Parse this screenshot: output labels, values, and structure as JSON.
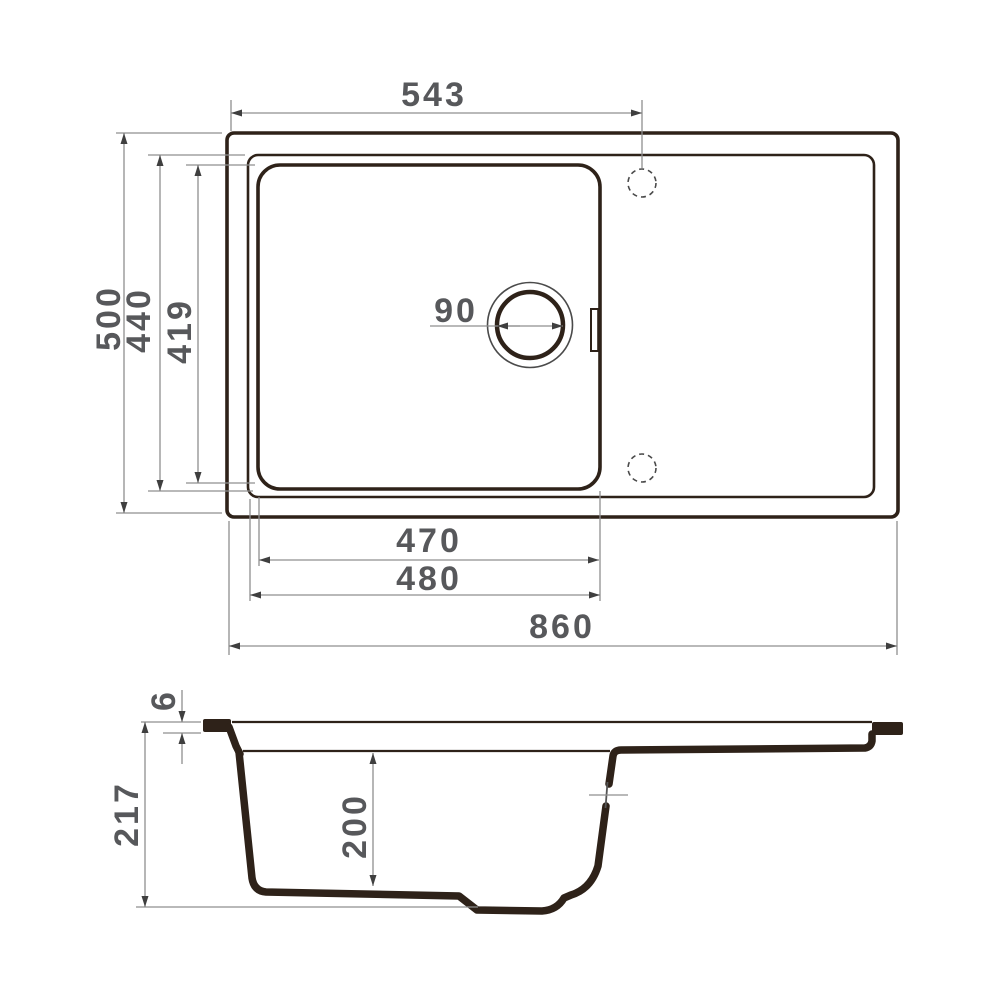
{
  "drawing": {
    "type": "sink-technical-drawing",
    "views": {
      "top_view_name": "plan-view",
      "section_view_name": "section-view"
    },
    "colors": {
      "outline": "#2e2219",
      "dimension_line": "#8f8f8f",
      "arrowhead": "#3f3f3f",
      "text": "#57585b",
      "background": "#ffffff"
    },
    "dims": {
      "top": {
        "left_edge_to_tap_hole": "543",
        "overall_depth": "500",
        "inner_rim_depth": "440",
        "bowl_inner_depth": "419",
        "drain_diameter": "90",
        "bowl_width_inner": "470",
        "bowl_width_outer": "480",
        "overall_width": "860"
      },
      "section": {
        "rim_thickness": "6",
        "overall_height": "217",
        "bowl_depth": "200"
      }
    }
  }
}
